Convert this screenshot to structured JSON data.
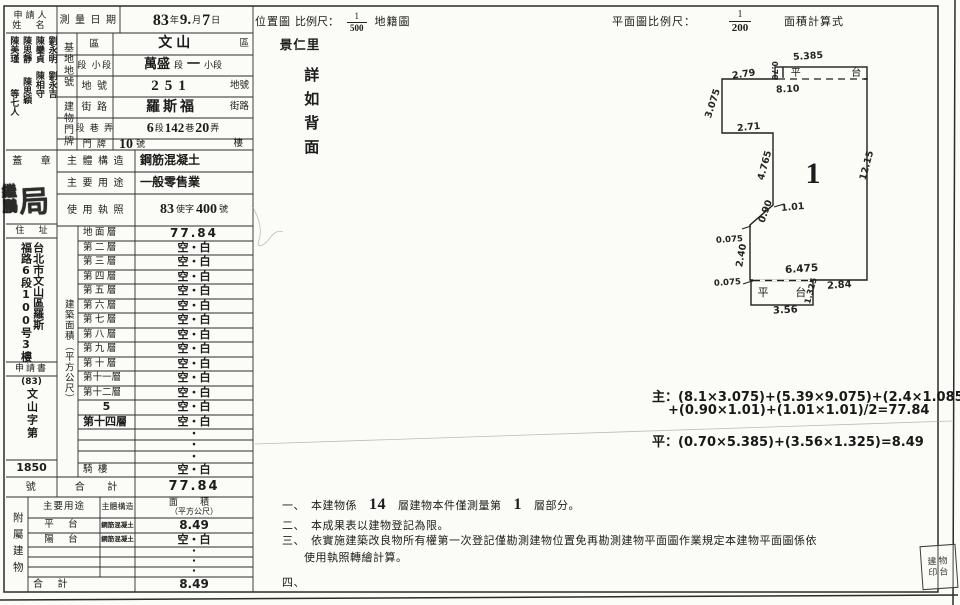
{
  "applicant": {
    "label_line1": "申請人",
    "label_line2": "姓 名",
    "name_cols": [
      {
        "top": "陳美瑾",
        "bottom": "等七人"
      },
      {
        "top": "陳思靜",
        "bottom": "陳思穎"
      },
      {
        "top": "陳鑾貞",
        "bottom": "陳相守"
      },
      {
        "top": "劉永明",
        "bottom": "劉永吉"
      }
    ]
  },
  "survey_date": {
    "label": "測 量 日 期",
    "y": "83",
    "y_unit": "年",
    "m": "9.",
    "m_unit": "月",
    "d": "7",
    "d_unit": "日"
  },
  "site": {
    "group_label": "基地地號",
    "district_label": "區",
    "district_value": "文山",
    "district_suffix": "區",
    "section_label": "段 小段",
    "section_value": "萬盛",
    "section_mid": "段",
    "section_dash": "一",
    "section_suffix": "小段",
    "lot_label": "地 號",
    "lot_value": "251",
    "lot_suffix": "地號"
  },
  "plate": {
    "group_label": "建物門牌",
    "street_label": "街 路",
    "street_value": "羅斯福",
    "street_suffix": "街路",
    "lane_label": "段 巷 弄",
    "lane_v1": "6",
    "lane_u1": "段",
    "lane_v2": "142",
    "lane_u2": "巷",
    "lane_v3": "20",
    "lane_u3": "弄",
    "door_label": "門 牌",
    "door_value": "10",
    "door_unit": "號",
    "door_suffix": "樓"
  },
  "seal_cell": {
    "label": "蓋 章",
    "glyph_left_top": "繼",
    "glyph_left_bottom": "鵬",
    "glyph_right": "局"
  },
  "structure": {
    "label": "主 體 構 造",
    "value": "鋼筋混凝土"
  },
  "usage": {
    "label": "主 要 用 途",
    "value": "一般零售業"
  },
  "license": {
    "label": "使 用 執 照",
    "v1": "83",
    "mid": "使字",
    "v2": "400",
    "suffix": "號"
  },
  "residence": {
    "label": "住 址",
    "line1": "台北市文山區羅斯",
    "line2": "福路6段100号3樓"
  },
  "application": {
    "label": "申請書",
    "code_pre": "(83)",
    "code_chars": "文山字第",
    "number": "1850",
    "suffix_label": "號"
  },
  "floor_area": {
    "col_label": "建築面積（平方公尺）",
    "rows": [
      {
        "label": "地 面 層",
        "value": "77.84"
      },
      {
        "label": "第 二 層",
        "value": "空・白"
      },
      {
        "label": "第 三 層",
        "value": "空・白"
      },
      {
        "label": "第 四 層",
        "value": "空・白"
      },
      {
        "label": "第 五 層",
        "value": "空・白"
      },
      {
        "label": "第 六 層",
        "value": "空・白"
      },
      {
        "label": "第 七 層",
        "value": "空・白"
      },
      {
        "label": "第 八 層",
        "value": "空・白"
      },
      {
        "label": "第 九 層",
        "value": "空・白"
      },
      {
        "label": "第 十 層",
        "value": "空・白"
      },
      {
        "label": "第十一層",
        "value": "空・白"
      },
      {
        "label": "第十二層",
        "value": "空・白"
      },
      {
        "label": "5",
        "value": "空・白"
      },
      {
        "label": "第十四層",
        "value": "空・白"
      },
      {
        "label": "",
        "value": "・"
      },
      {
        "label": "",
        "value": "・"
      },
      {
        "label": "",
        "value": "・"
      },
      {
        "label": "騎 樓",
        "value": "空・白"
      }
    ],
    "total_label": "合 計",
    "total_value": "77.84"
  },
  "attached": {
    "col_label": "附屬建物",
    "header": {
      "use": "主要用途",
      "structure": "主體構造",
      "area1": "面 積",
      "area2": "（平方公尺）"
    },
    "rows": [
      {
        "use": "平 台",
        "structure": "鋼筋混凝土",
        "area": "8.49"
      },
      {
        "use": "陽 台",
        "structure": "鋼筋混凝土",
        "area": "空・白"
      },
      {
        "use": "",
        "structure": "",
        "area": "・"
      },
      {
        "use": "",
        "structure": "",
        "area": "・"
      },
      {
        "use": "",
        "structure": "",
        "area": "・"
      }
    ],
    "total_label": "合 計",
    "total_value": "8.49"
  },
  "maps": {
    "location_label": "位置圖",
    "scale_label": "比例尺：",
    "location_num": "1",
    "location_den": "500",
    "cadastral_label": "地籍圖",
    "plan_scale_label": "平面圖比例尺：",
    "plan_num": "1",
    "plan_den": "200",
    "calc_label": "面積計算式",
    "village": "景仁里",
    "back_note": "詳如背面"
  },
  "plan": {
    "unit_number": "1",
    "platform_top_label": "平 台",
    "platform_bottom_label": "平 台",
    "dims": {
      "top": "5.385",
      "platform_left": "0.70",
      "inner_top": "8.10",
      "top_left": "2.79",
      "left_upper": "3.075",
      "step": "2.71",
      "left_mid": "4.765",
      "right": "12.15",
      "diag_tick": "1.01",
      "diag": "0.90",
      "offset_upper": "0.075",
      "left_lower": "2.40",
      "offset_lower": "0.075",
      "bottom_inner": "6.475",
      "bottom_right": "2.84",
      "platform_right": "1.325",
      "platform_bottom": "3.56"
    }
  },
  "formulas": {
    "main_line1": "主：(8.1×3.075)+(5.39×9.075)+(2.4×1.085)",
    "main_line2": "+(0.90×1.01)+(1.01×1.01)/2=77.84",
    "platform_line": "平：(0.70×5.385)+(3.56×1.325)=8.49"
  },
  "notes": {
    "n1_bullet": "一、",
    "n1_pre": "本建物係",
    "n1_big1": "14",
    "n1_mid": "層建物本件僅測量第",
    "n1_big2": "1",
    "n1_post": "層部分。",
    "n2_bullet": "二、",
    "n2": "本成果表以建物登記為限。",
    "n3_bullet": "三、",
    "n3_line1": "依實施建築改良物所有權第一次登記僅勘測建物位置免再勘測建物平面圖作業規定本建物平面圖係依",
    "n3_line2": "使用執照轉繪計算。",
    "n4_bullet": "四、"
  },
  "corner_seal": {
    "line1": "建物",
    "line2": "印台"
  }
}
